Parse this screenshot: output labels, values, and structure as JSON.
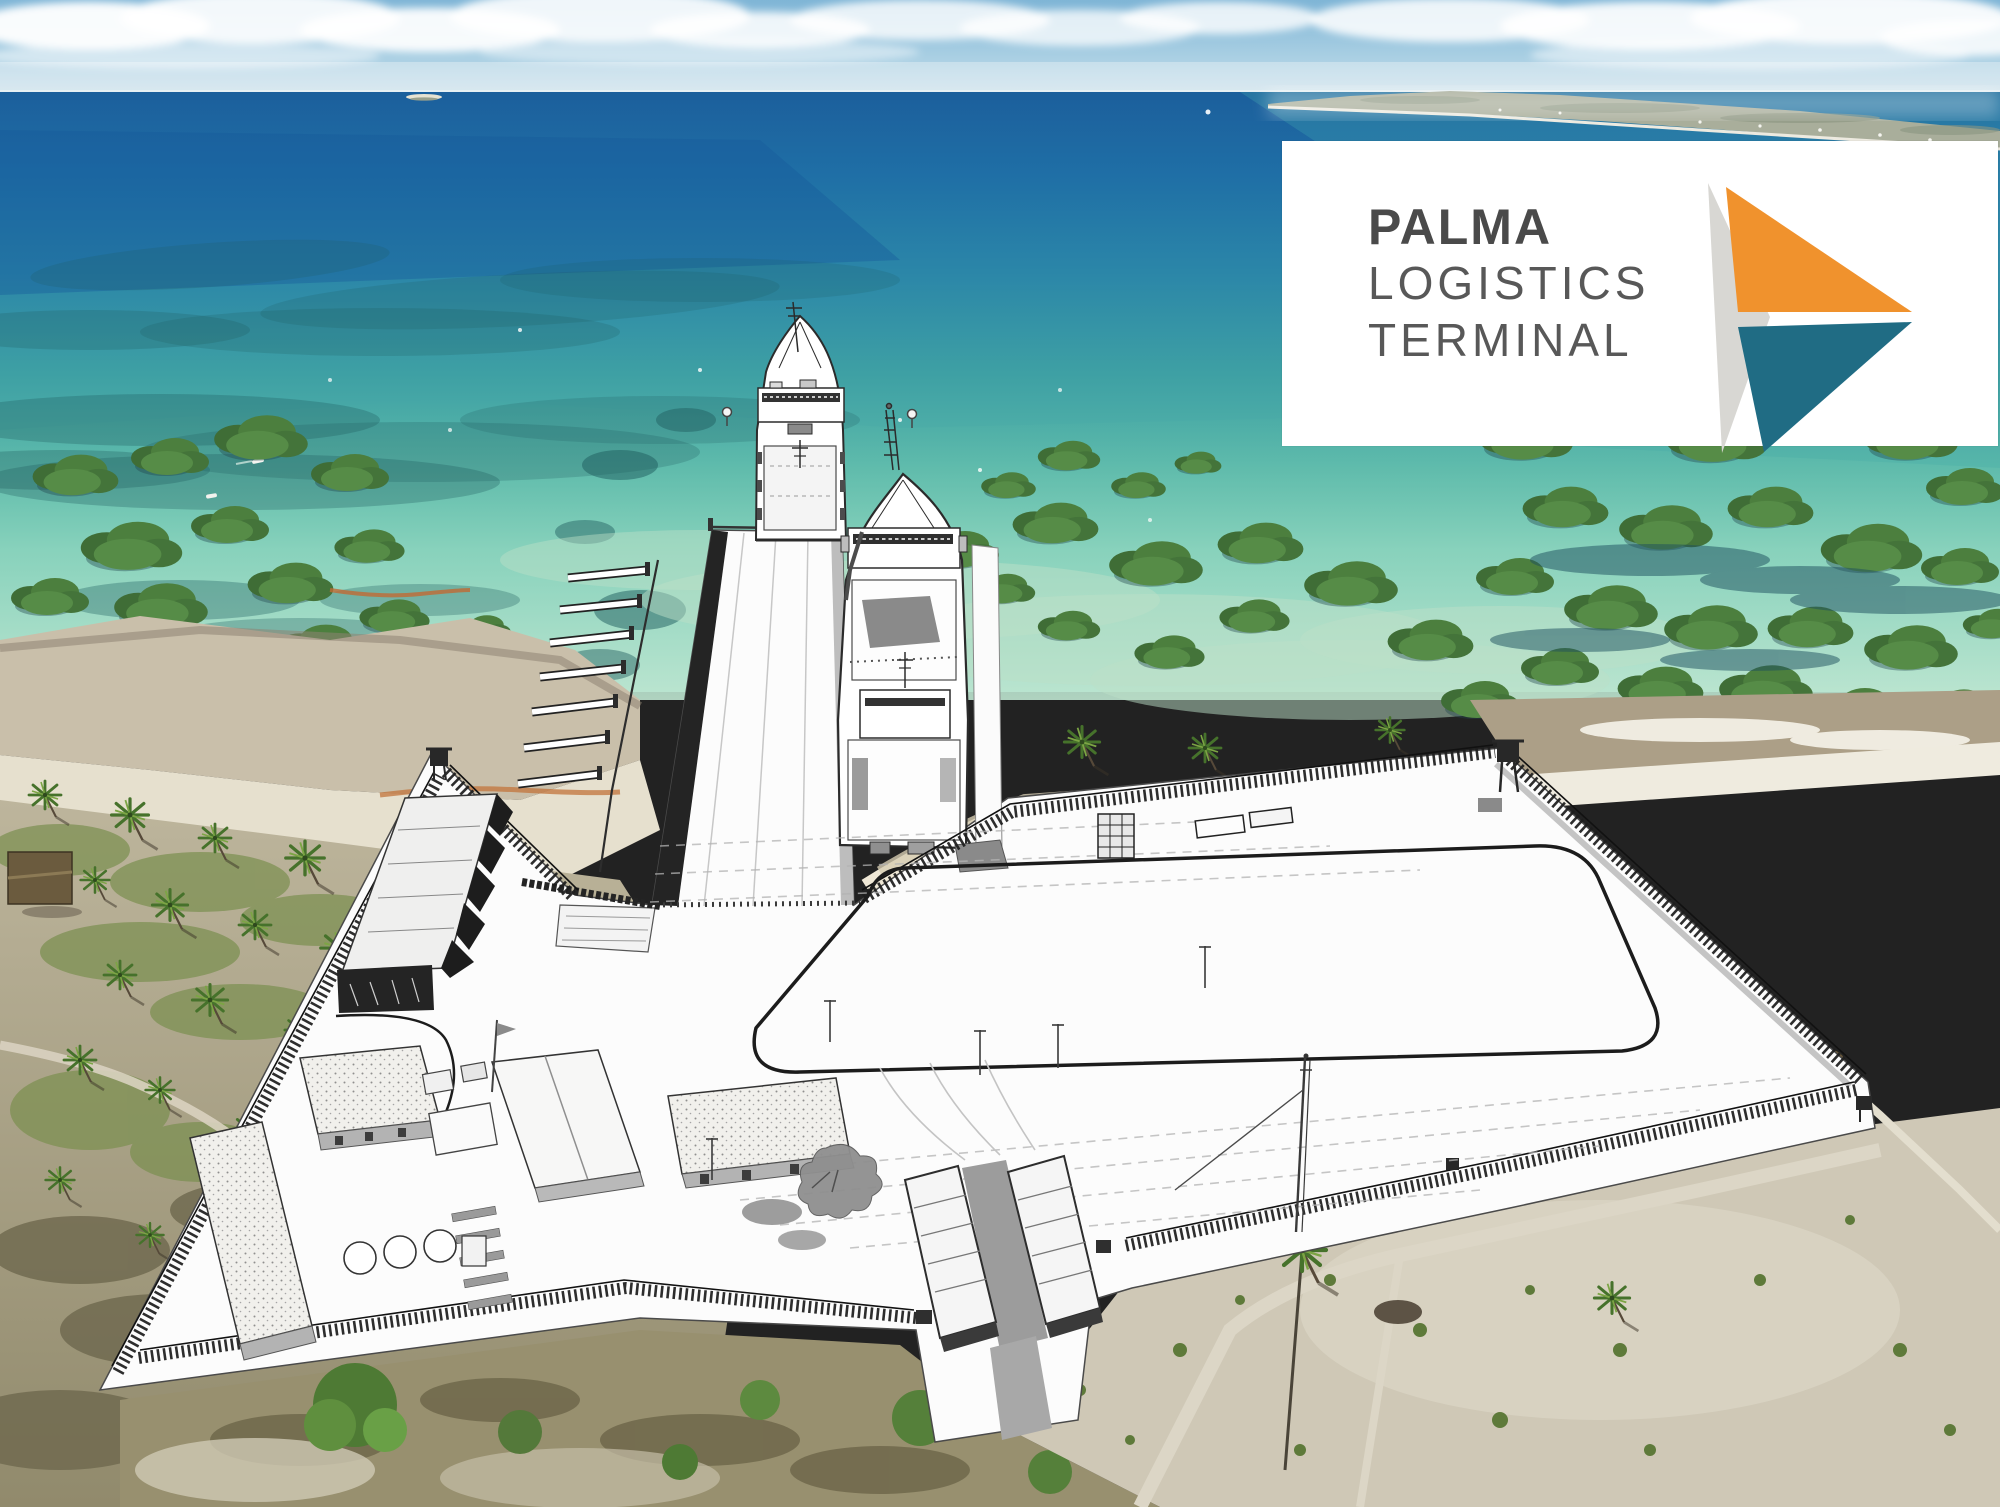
{
  "logo_card": {
    "line1": "PALMA",
    "line2": "LOGISTICS",
    "line3": "TERMINAL",
    "colors": {
      "background": "#ffffff",
      "text_bold": "#4a4a4a",
      "text_light": "#585858",
      "arrow_orange": "#f0922d",
      "arrow_teal": "#206c84",
      "arrow_gray": "#d8d7d3"
    }
  },
  "scene": {
    "type": "aerial-photo-with-architectural-sketch-overlay",
    "features": [
      "sky-with-cumulus-clouds",
      "distant-coastline",
      "deep-blue-ocean",
      "turquoise-lagoon-shallows",
      "seagrass-patches",
      "mangrove-clusters",
      "mudflat-and-beach",
      "palm-grove",
      "thatched-hut",
      "terminal-platform-sketch",
      "approach-pier",
      "roro-ship-far",
      "roro-ship-near",
      "mooring-dolphins",
      "perimeter-fence",
      "guard-towers",
      "warehouse",
      "admin-buildings",
      "storage-tanks",
      "gate-canopies",
      "ring-road",
      "flag-masts",
      "containers",
      "scrubland",
      "sand-tracks"
    ],
    "colors": {
      "sky_top": "#7fb5d6",
      "ocean_deep": "#1f6fa6",
      "lagoon_turquoise": "#68c4b1",
      "mangrove_green": "#4c7f3e",
      "sand": "#d3ccba",
      "sketch_ink": "#222222",
      "platform_white": "#fcfcfc"
    }
  }
}
